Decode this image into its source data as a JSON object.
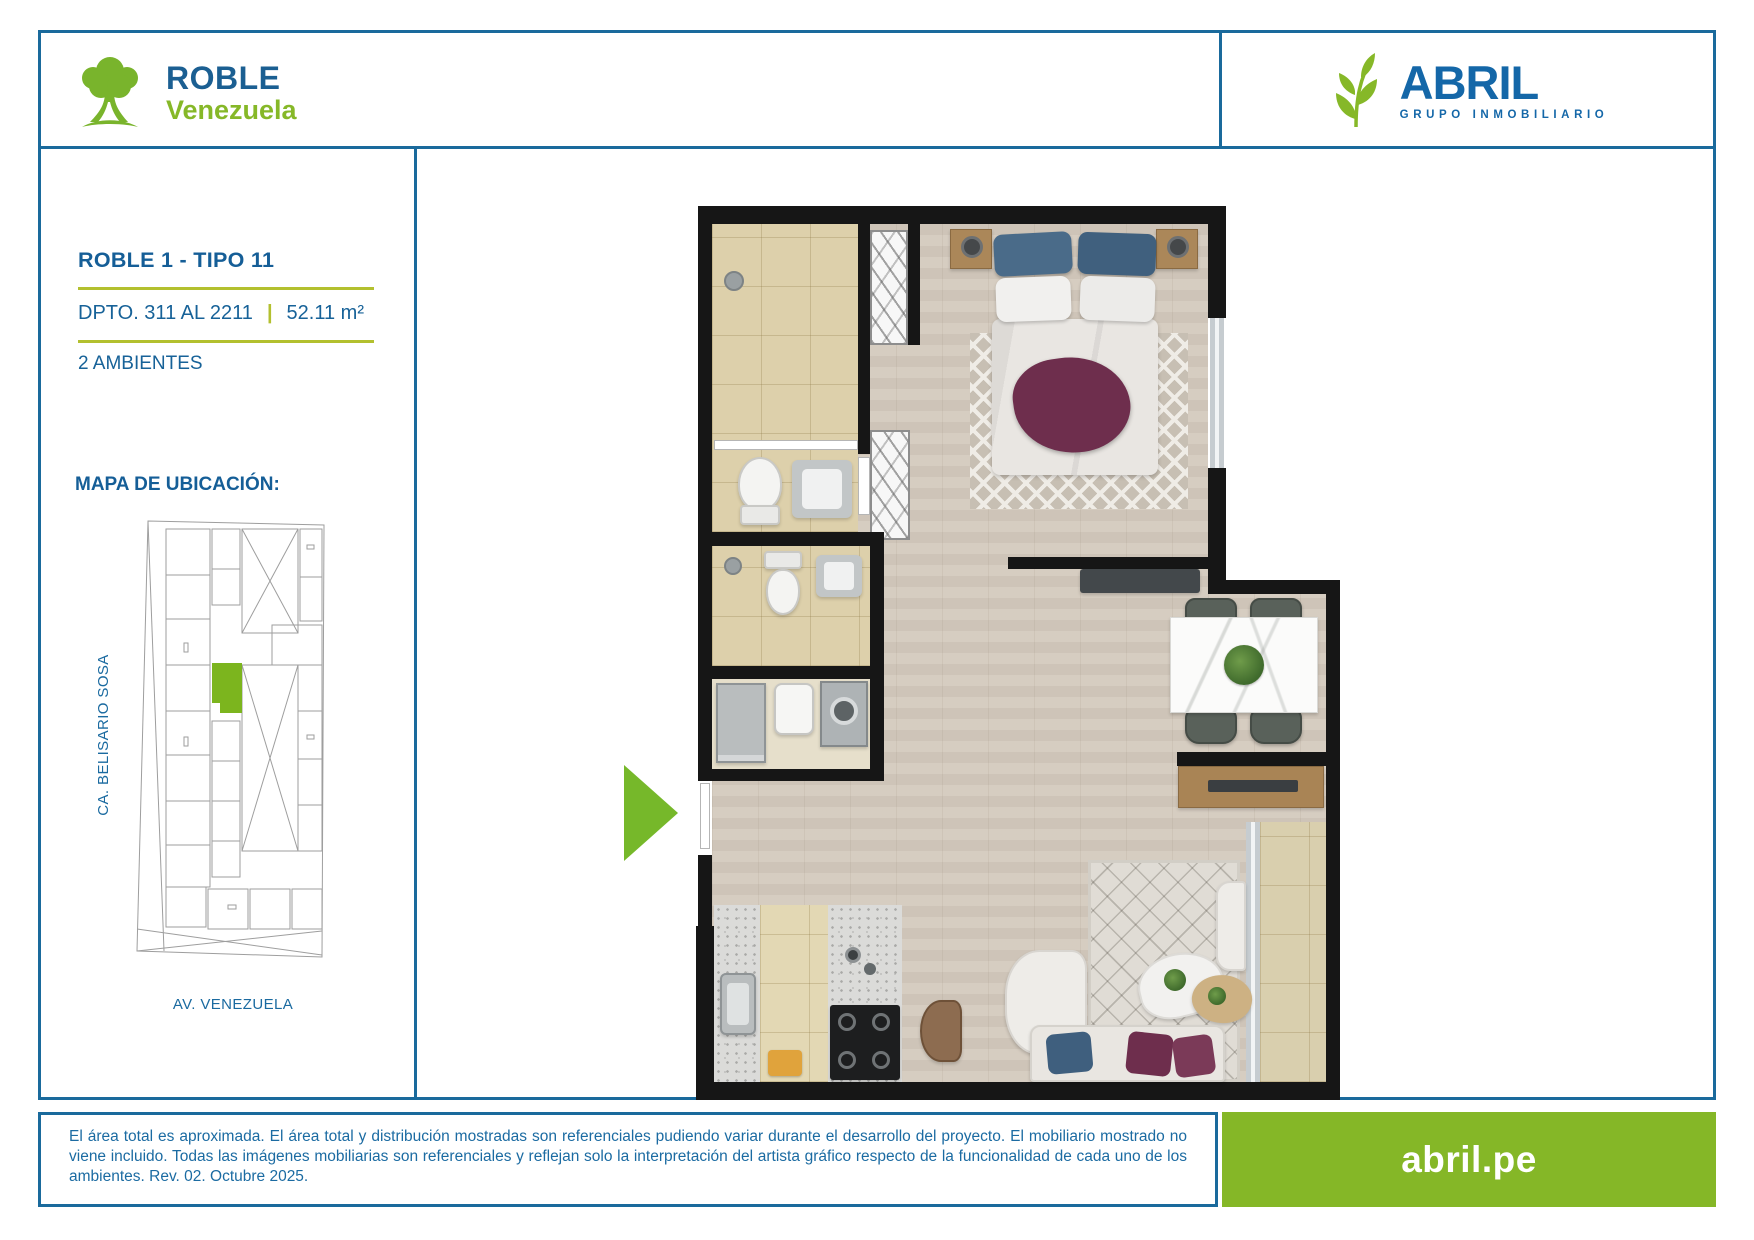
{
  "page": {
    "background": "#ffffff",
    "border_color": "#1a6a9c"
  },
  "header": {
    "roble_logo": {
      "name": "ROBLE",
      "location": "Venezuela"
    },
    "abril_logo": {
      "name": "ABRIL",
      "tagline": "GRUPO INMOBILIARIO"
    }
  },
  "info_panel": {
    "plan_title": "ROBLE 1 - TIPO 11",
    "unit_range": "DPTO. 311 AL 2211",
    "separator": "|",
    "area": "52.11 m²",
    "rooms": "2 AMBIENTES",
    "map_heading": "MAPA DE UBICACIÓN:",
    "street_left": "CA. BELISARIO SOSA",
    "street_bottom": "AV. VENEZUELA"
  },
  "footer": {
    "disclaimer": "El área total es aproximada. El área total y distribución mostradas son referenciales pudiendo variar durante el desarrollo del proyecto. El mobiliario mostrado no viene incluido. Todas las imágenes mobiliarias son referenciales y reflejan solo la interpretación del artista gráfico respecto de la funcionalidad de cada uno de los ambientes. Rev. 02. Octubre 2025.",
    "website": "abril.pe"
  },
  "colors": {
    "brand_blue": "#1a6a9c",
    "brand_green": "#86b828",
    "rule_green": "#b3c02f",
    "map_highlight_green": "#7cb51e",
    "entry_arrow_green": "#76b82a"
  }
}
